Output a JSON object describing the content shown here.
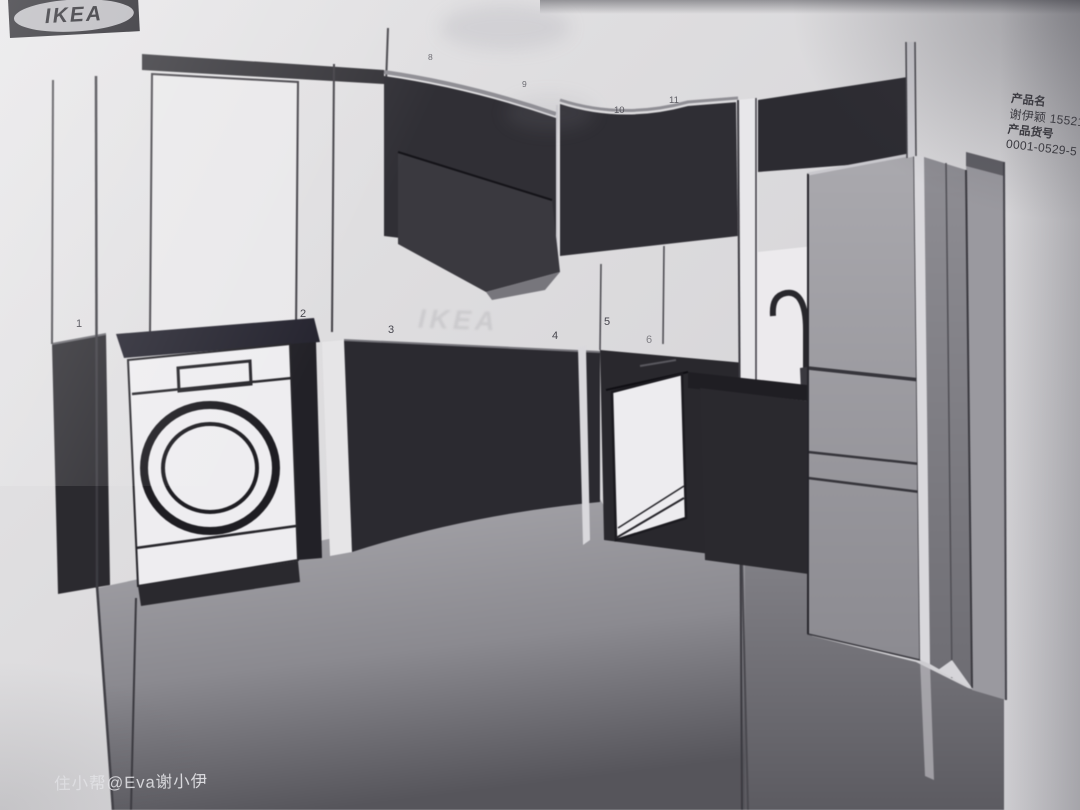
{
  "document": {
    "brand": "IKEA",
    "product_fields": [
      {
        "label": "产品名",
        "value": "谢伊颖 155210"
      },
      {
        "label": "产品货号",
        "value": "0001-0529-5"
      }
    ],
    "watermark": "住小帮@Eva谢小伊",
    "bleed_text": "IKEA",
    "callouts": [
      "1",
      "2",
      "3",
      "4",
      "5",
      "6",
      "8",
      "9",
      "10",
      "11"
    ]
  },
  "colors": {
    "paper": "#dedddf",
    "logo_dark": "#242329",
    "logo_oval": "#b8b7bc",
    "cabinet_dark": "#2e2d33",
    "appliance_white": "#eeedf0",
    "fridge_gray": "#a0a0a6",
    "floor_light": "#a6a5aa",
    "floor_dark": "#57565c",
    "text_dark": "#39383e",
    "watermark_white": "#f2f2f6"
  }
}
